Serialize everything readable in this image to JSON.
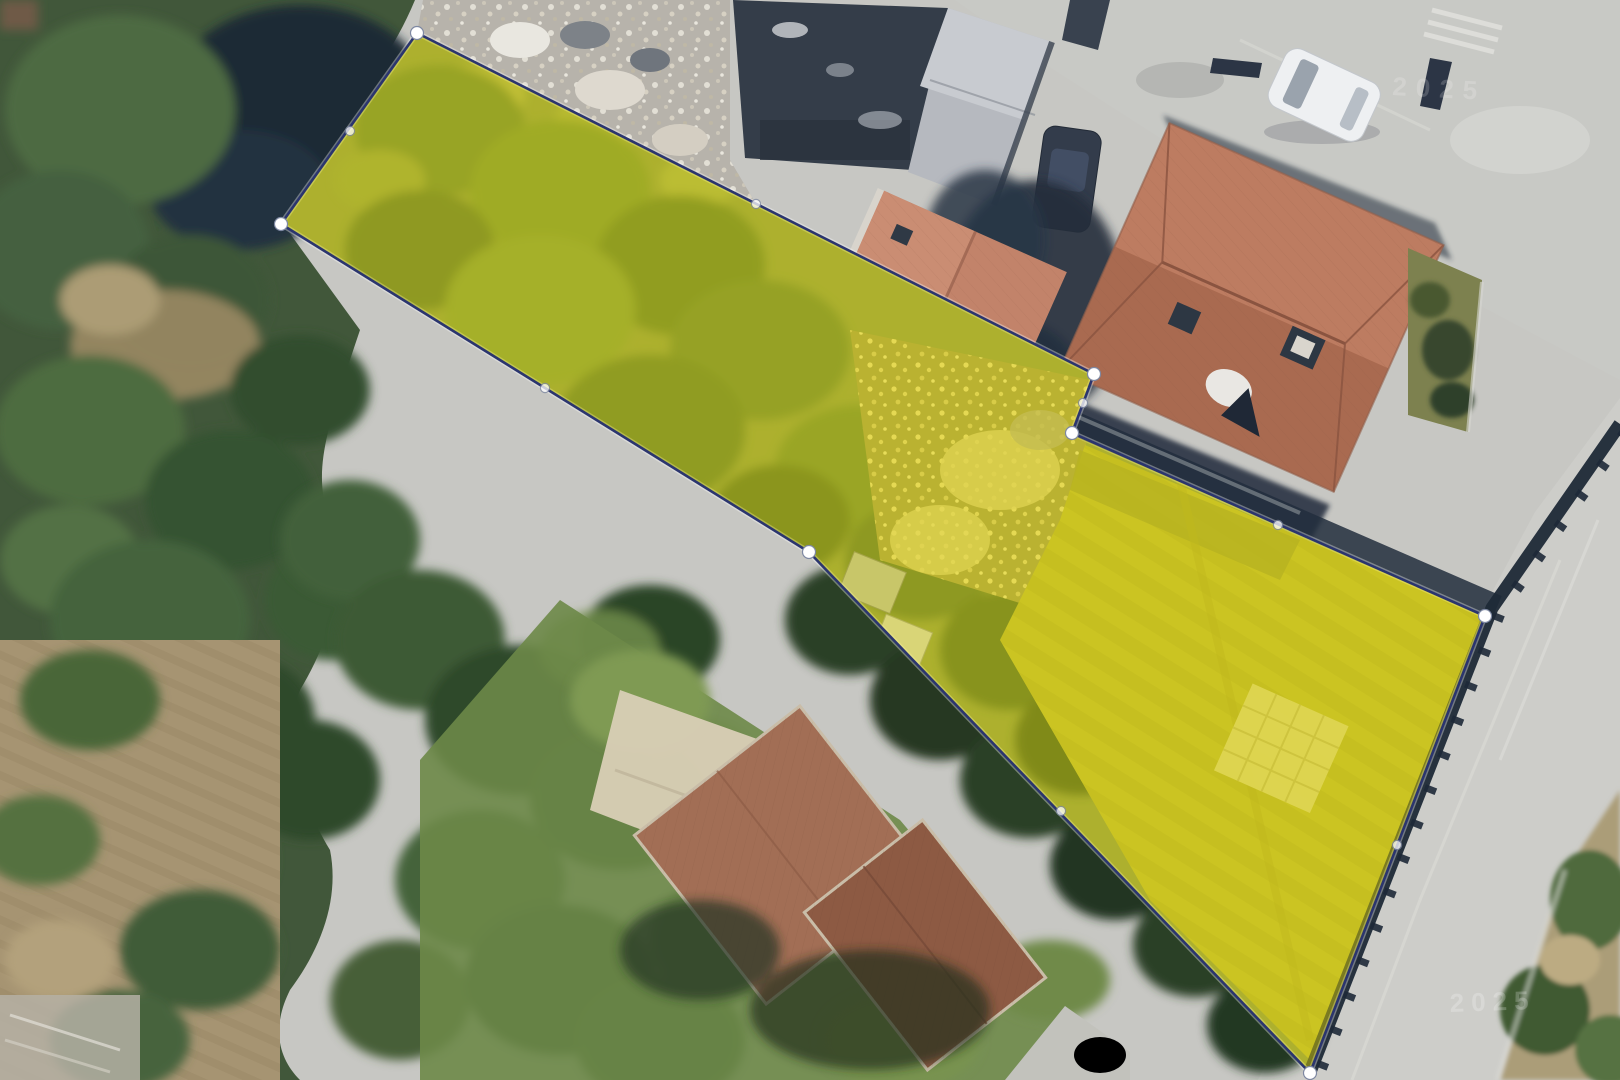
{
  "watermarks": {
    "top_right": "2025",
    "bottom_right": "2025"
  },
  "parcel": {
    "fill_color": "#f2e400",
    "fill_opacity": 0.42,
    "stroke_color": "#2b356e",
    "stroke_width": 2.6,
    "halo_color": "#ffffff",
    "halo_opacity": 0.35,
    "halo_width": 5.5,
    "vertex_color": "#ffffff",
    "vertex_stroke": "#7e88a2",
    "vertex_radius": 6.5,
    "midpoint_radius": 4.6,
    "midpoint_opacity": 0.75,
    "vertices": [
      {
        "x": 417,
        "y": 33
      },
      {
        "x": 1094,
        "y": 374
      },
      {
        "x": 1072,
        "y": 433
      },
      {
        "x": 1485,
        "y": 616
      },
      {
        "x": 1310,
        "y": 1073
      },
      {
        "x": 809,
        "y": 552
      },
      {
        "x": 281,
        "y": 224
      }
    ],
    "midpoints": [
      {
        "x": 756,
        "y": 204
      },
      {
        "x": 1083,
        "y": 403
      },
      {
        "x": 1278,
        "y": 525
      },
      {
        "x": 1397,
        "y": 845
      },
      {
        "x": 1061,
        "y": 811
      },
      {
        "x": 545,
        "y": 388
      },
      {
        "x": 350,
        "y": 131
      }
    ]
  }
}
